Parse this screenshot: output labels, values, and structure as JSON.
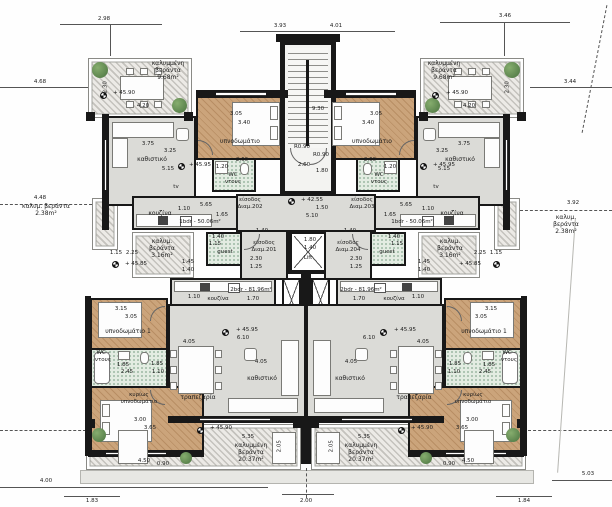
{
  "colors": {
    "wall": "#181818",
    "wood": "#c2996f",
    "tile": "#dbdbd7",
    "bath": "#e3ece2",
    "hatch": "#c4c2bd",
    "plant": "#4a7340"
  },
  "dimensions": {
    "top": [
      "2.98",
      "3.93",
      "4.01",
      "3.46"
    ],
    "left": [
      "4.68",
      "4.48",
      "4.00"
    ],
    "right": [
      "3.44",
      "3.92",
      "5.03"
    ],
    "bottom": [
      "1.83",
      "2.00",
      "1.84"
    ]
  },
  "levels": {
    "entry": "+ 42.55",
    "floor": "+ 45.95",
    "veranda": "+ 45.90",
    "side_veranda": "+ 45.85"
  },
  "core": {
    "stair_width": "9.30",
    "stair_radius1": "R0.90",
    "stair_radius2": "R0.90",
    "stair_d1": "2.60",
    "stair_d2": "1.80",
    "hall_w": "1.50",
    "hall_l": "5.10",
    "lift_label": "Lift",
    "lift_w": "1.80",
    "lift_d": "1.40"
  },
  "rooms": {
    "bedroom": "υπνοδωμάτιο",
    "bedroom1": "υπνοδωμάτιο 1",
    "master": "κυρίως\nυπνοδωμάτιο",
    "living": "καθιστικό",
    "kitchen": "κουζίνα",
    "dining": "τραπεζαρία",
    "wc": "WC\nντους",
    "wc2": "WC -\nντους",
    "guest": "guest",
    "tv": "tv"
  },
  "verandas": {
    "top": "καλυμμένη\nβεράντα\n9.68m²",
    "side": "καλυμ. βεράντα\n2.38m²",
    "small": "καλυμ.\nβεράντα\n3.16m²",
    "bottom": "καλυμμένη\nβεράντα\n20.37m²"
  },
  "units": {
    "one_bdr": "1bdr - 50.06m²",
    "two_bdr": "2bdr - 81.96m²"
  },
  "entrances": {
    "a201": "είσοδος\nΔιαμ.201",
    "a202": "είσοδος\nΔιαμ.202",
    "a203": "είσοδος\nΔιαμ.203",
    "a204": "είσοδος\nΔιαμ.204"
  },
  "measures": {
    "veranda_w": "4.20",
    "veranda_h": "2.30",
    "bed_a": "3.05",
    "bed_b": "3.40",
    "liv_a": "3.75",
    "liv_b": "3.25",
    "liv_c": "5.15",
    "kit_a": "1.10",
    "kit_b": "5.65",
    "kit_c": "1.65",
    "wc_a": "2.60",
    "wc_b": "1.20",
    "sv_a": "1.15",
    "sv_b": "2.25",
    "sv_c": "1.45",
    "sv_d": "1.40",
    "ent_a": "2.30",
    "ent_b": "1.25",
    "ent_c": "1.40",
    "guest_a": "1.40",
    "guest_b": "1.15",
    "cor_a": "1.70",
    "kit2_a": "1.10",
    "b1_a": "3.15",
    "b1_b": "3.05",
    "wc2_a": "1.85",
    "wc2_b": "2.45",
    "wc2_c": "1.85",
    "wc2_d": "1.10",
    "mb_a": "3.00",
    "mb_b": "3.65",
    "lv2_a": "4.05",
    "lv2_b": "6.10",
    "dn_a": "4.05",
    "vb_a": "5.35",
    "vb_b": "2.05",
    "vb_c": "4.50",
    "vb_d": "0.90"
  }
}
